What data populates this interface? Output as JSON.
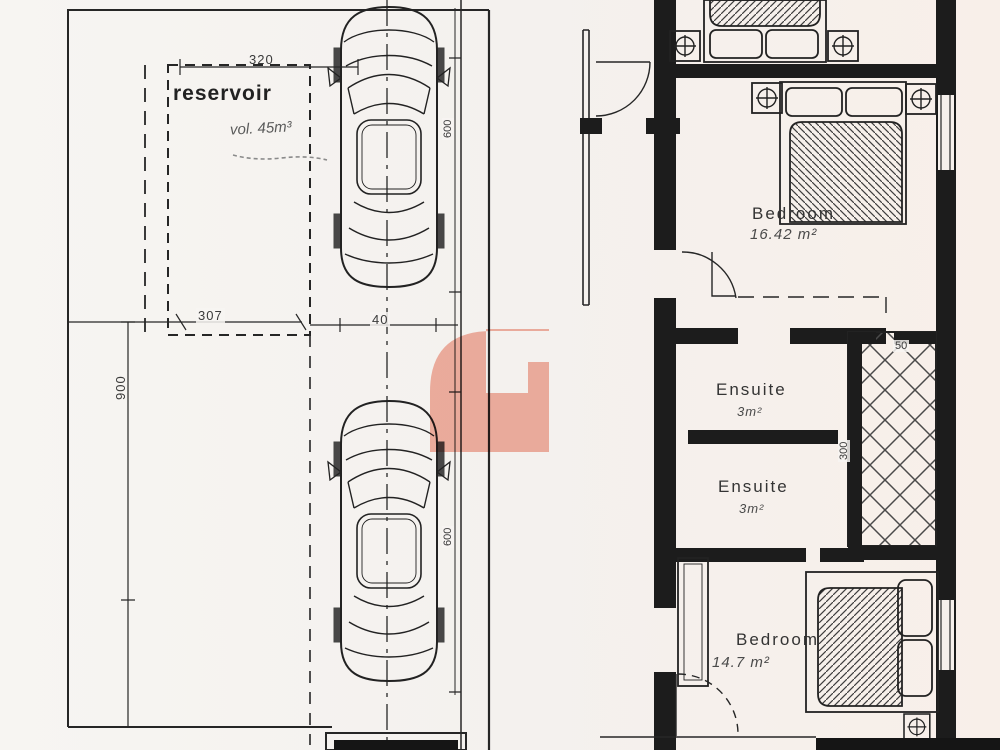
{
  "drawing": {
    "left_plan": {
      "reservoir_label": "reservoir",
      "volume_note": "vol. 45m³",
      "dimensions": {
        "top_width": "320",
        "side_width": "307",
        "length": "900",
        "car_gap": "40",
        "car_length_1": "600",
        "car_length_2": "600"
      }
    },
    "right_plan": {
      "rooms": [
        {
          "name": "Bedroom",
          "area": "16.42 m²"
        },
        {
          "name": "Ensuite",
          "area": "3m²"
        },
        {
          "name": "Ensuite",
          "area": "3m²"
        },
        {
          "name": "Bedroom",
          "area": "14.7 m²"
        }
      ],
      "dimensions": {
        "shaft_opening": "50",
        "shaft_depth": "300"
      }
    },
    "watermark": {
      "shape": "letter-G",
      "color": "#f4b4a6"
    }
  }
}
